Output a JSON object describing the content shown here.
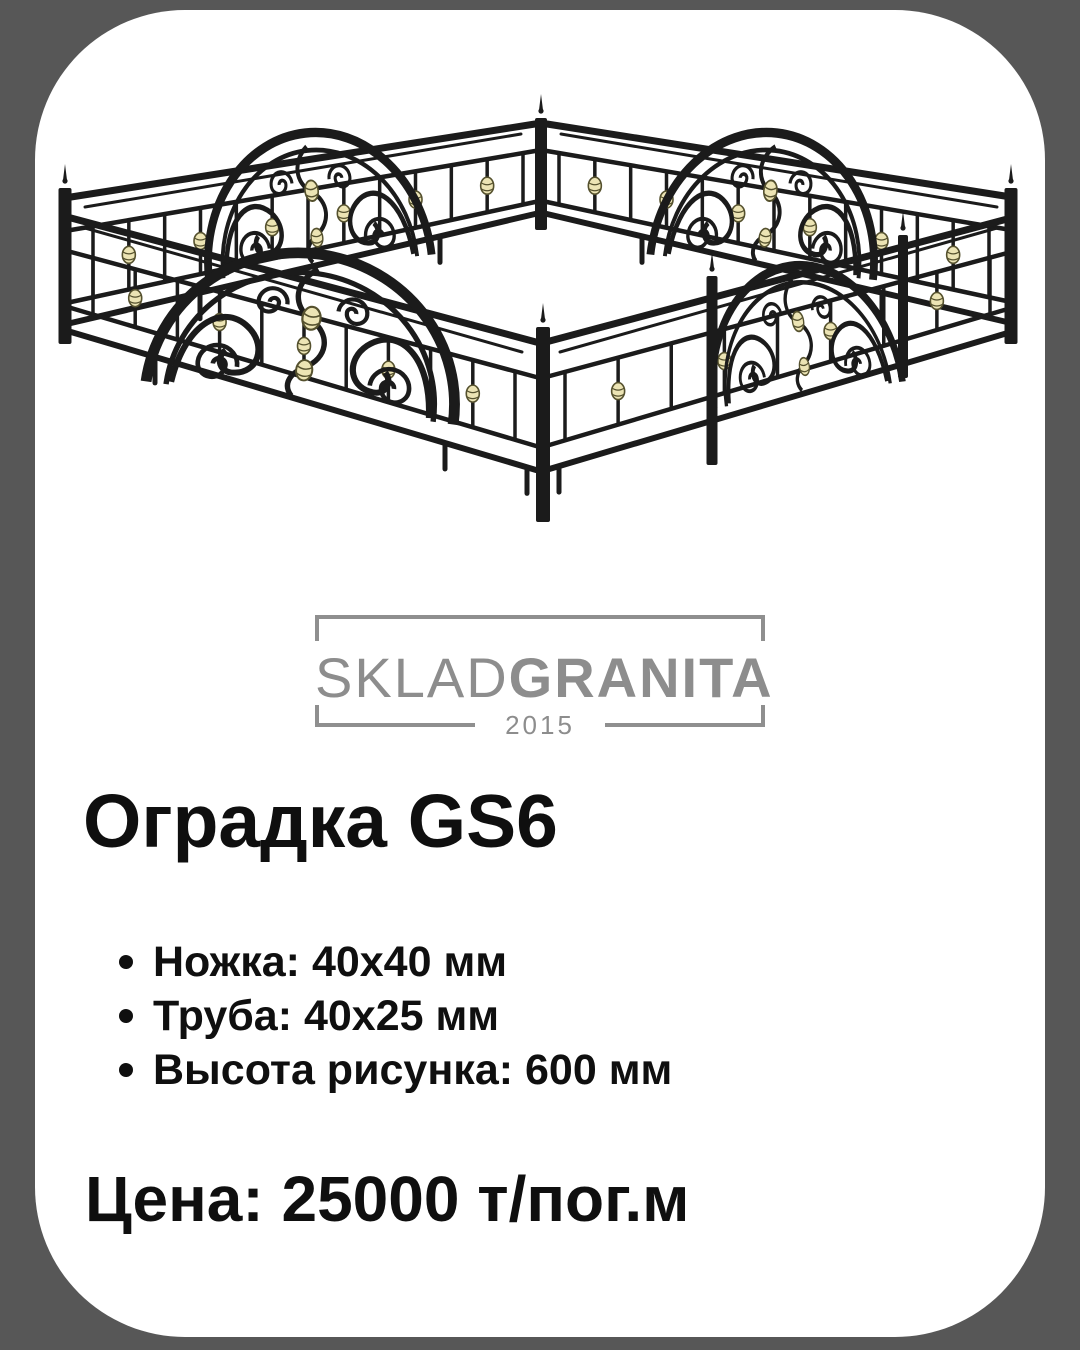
{
  "page": {
    "background": "#575757",
    "card_background": "#ffffff"
  },
  "logo": {
    "brand_regular": "SKLAD",
    "brand_bold": "GRANITA",
    "year": "2015",
    "color": "#8d8d8d"
  },
  "product": {
    "title": "Оградка GS6",
    "specs": [
      "Ножка: 40х40 мм",
      "Труба: 40х25 мм",
      "Высота рисунка: 600 мм"
    ],
    "price": "Цена: 25000 т/пог.м"
  },
  "illustration": {
    "type": "wrought-iron-grave-fence",
    "iron_color": "#1b1b1b",
    "accent_color": "#ece4b4",
    "accent_edge_color": "#55512e"
  }
}
